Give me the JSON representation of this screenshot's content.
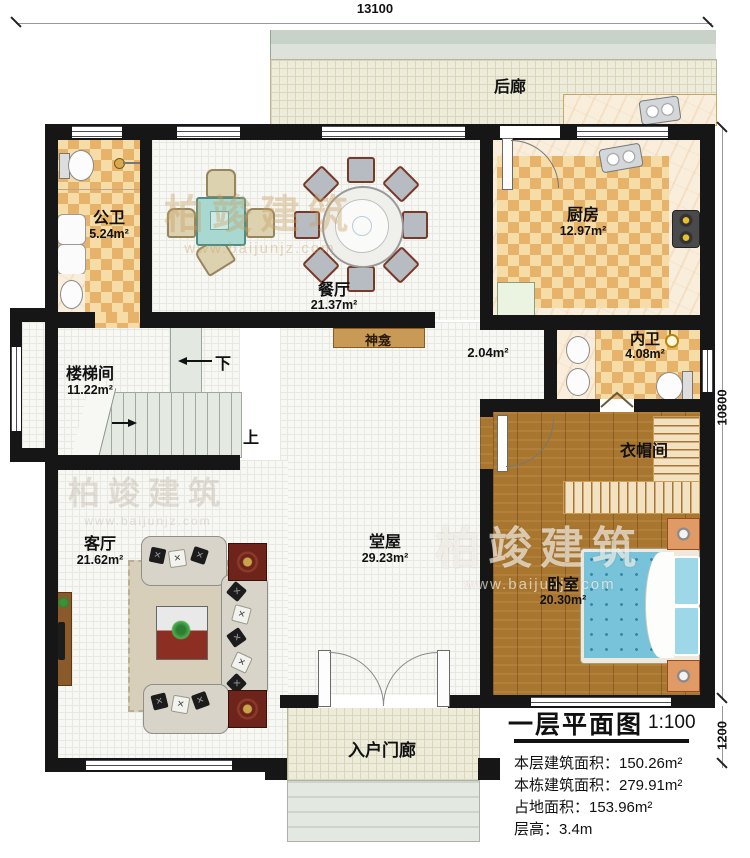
{
  "dimensions": {
    "top": "13100",
    "side": "10800",
    "porch": "1200"
  },
  "rooms": {
    "back_porch": {
      "name": "后廊"
    },
    "public_bath": {
      "name": "公卫",
      "area": "5.24m²"
    },
    "dining": {
      "name": "餐厅",
      "area": "21.37m²"
    },
    "kitchen": {
      "name": "厨房",
      "area": "12.97m²"
    },
    "inner_bath": {
      "name": "内卫",
      "area": "4.08m²"
    },
    "stairwell": {
      "name": "楼梯间",
      "area": "11.22m²"
    },
    "shrine": {
      "name": "神龛"
    },
    "passage": {
      "area": "2.04m²"
    },
    "closet": {
      "name": "衣帽间"
    },
    "living": {
      "name": "客厅",
      "area": "21.62m²"
    },
    "hall": {
      "name": "堂屋",
      "area": "29.23m²"
    },
    "bedroom": {
      "name": "卧室",
      "area": "20.30m²"
    },
    "entry_porch": {
      "name": "入户门廊"
    }
  },
  "stairs": {
    "down_label": "下",
    "up_label": "上"
  },
  "titleblock": {
    "title": "一层平面图",
    "scale": "1:100",
    "floor_area": "本层建筑面积：150.26m²",
    "total_area": "本栋建筑面积：279.91m²",
    "footprint_area": "占地面积：153.96m²",
    "floor_height": "层高：3.4m"
  },
  "watermark": {
    "brand": "柏竣建筑",
    "url": "www.baijunjz.com"
  },
  "colors": {
    "wall": "#161616",
    "checker": "#e7b269",
    "wood": "#a8762f",
    "bed": "#79c3da",
    "shrine": "#c99a55"
  }
}
